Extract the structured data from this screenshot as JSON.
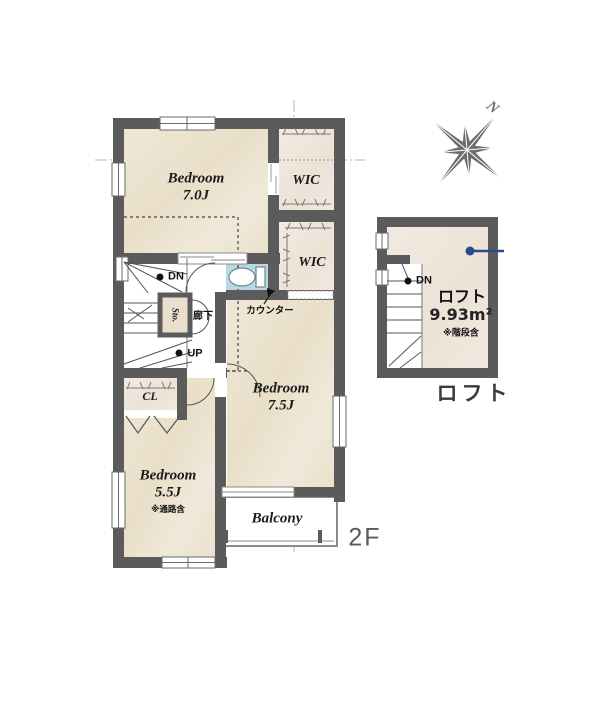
{
  "floor_label": "2F",
  "compass": {
    "north_label": "N"
  },
  "rooms": {
    "bedroom1": {
      "name": "Bedroom",
      "size": "7.0J"
    },
    "bedroom2": {
      "name": "Bedroom",
      "size": "7.5J"
    },
    "bedroom3": {
      "name": "Bedroom",
      "size": "5.5J",
      "note": "※通路含"
    },
    "wic1": {
      "label": "WIC"
    },
    "wic2": {
      "label": "WIC"
    },
    "closet": {
      "label": "CL"
    },
    "storage": {
      "label": "Sto."
    },
    "hallway": {
      "label": "廊下"
    },
    "counter": {
      "label": "カウンター"
    },
    "balcony": {
      "label": "Balcony"
    }
  },
  "stairs": {
    "down_label": "DN",
    "up_label": "UP"
  },
  "loft": {
    "title": "ロフト",
    "area": "9.93m²",
    "note": "※階段含",
    "down_label": "DN",
    "caption": "ロフト"
  },
  "colors": {
    "wall": "#5b5b5b",
    "room_cream": "#ece4d1",
    "wic_fill": "#f0e8e0",
    "toilet_blue": "#b7d7e3",
    "annotation_blue": "#2b4a8c",
    "compass_gray": "#6d6d6d"
  }
}
